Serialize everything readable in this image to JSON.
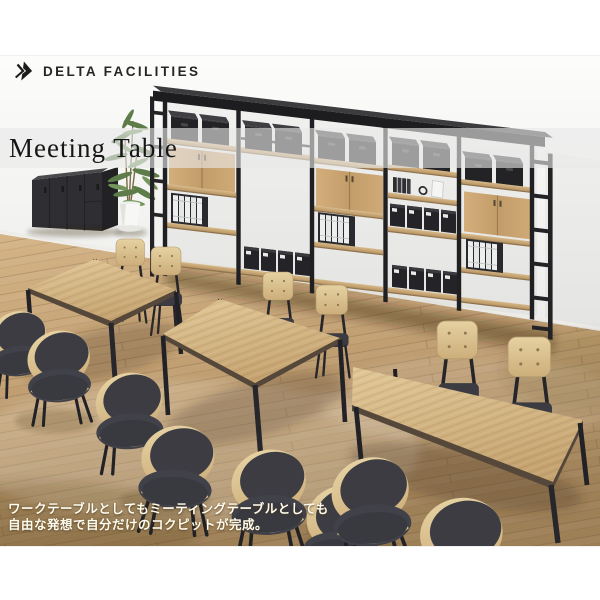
{
  "header": {
    "brand": "DELTA FACILITIES"
  },
  "banner": {
    "title": "Meeting Table"
  },
  "caption": {
    "line1": "ワークテーブルとしてもミーティングテーブルとしても",
    "line2": "自由な発想で自分だけのコクピットが完成。"
  },
  "icons": {
    "logo": "double-chevron-right-icon"
  },
  "scene": {
    "objects": [
      {
        "name": "shelving-unit",
        "count": 1
      },
      {
        "name": "storage-cabinet",
        "count": 1
      },
      {
        "name": "potted-plant",
        "count": 1
      },
      {
        "name": "meeting-table",
        "count": 3
      },
      {
        "name": "chair",
        "count": 12
      }
    ]
  },
  "colors": {
    "background": "#ffffff",
    "wall": "#f6f6f4",
    "banner_overlay": "#e9e9e9",
    "title_text": "#1a1a1a",
    "brand_text": "#262626",
    "caption_text": "#fffdf0",
    "wood_table": "#d3b283",
    "wood_floor": "#c09d70",
    "frame_black": "#1f1f22",
    "seat_charcoal": "#3c3c42",
    "plywood": "#dcc492",
    "plant_green": "#5f7f4a"
  }
}
